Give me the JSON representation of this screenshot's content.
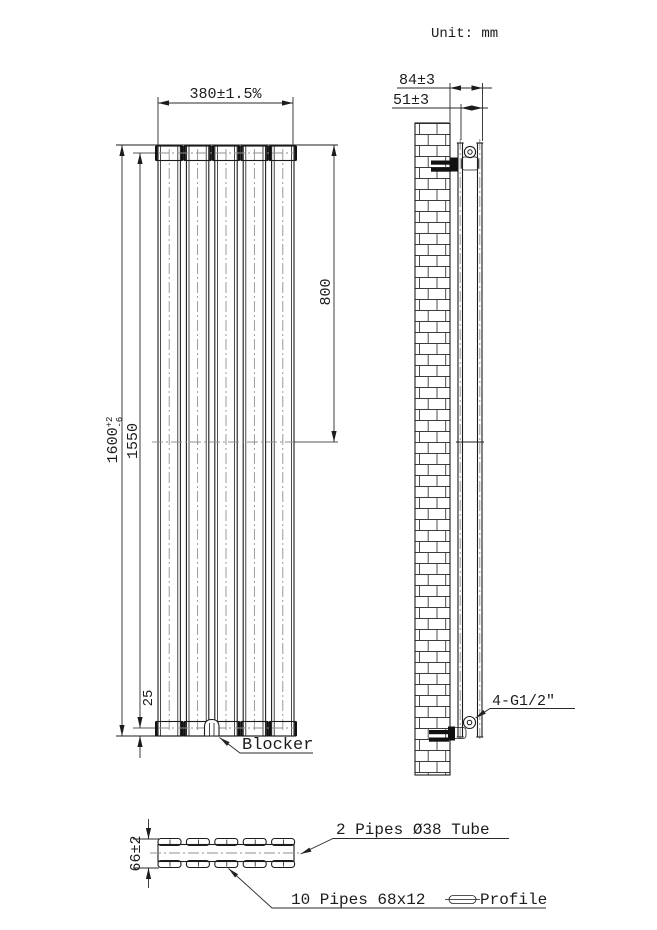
{
  "title": {
    "unit": "Unit: mm"
  },
  "front_view": {
    "dim_width": "380±1.5%",
    "dim_height_main": "1600",
    "dim_height_tol_plus": "+2",
    "dim_height_tol_minus": "-6",
    "dim_height_inner": "1550",
    "dim_top_to_center": "800",
    "dim_bottom_offset": "25",
    "blocker_label": "Blocker"
  },
  "side_view": {
    "dim_wall_to_front": "84±3",
    "dim_depth": "51±3",
    "connection_label": "4-G1/2\""
  },
  "section_view": {
    "dim_depth": "66±2",
    "label_tube": "2 Pipes Ø38 Tube",
    "label_pipes": "10 Pipes 68x12",
    "label_profile": "Profile"
  }
}
